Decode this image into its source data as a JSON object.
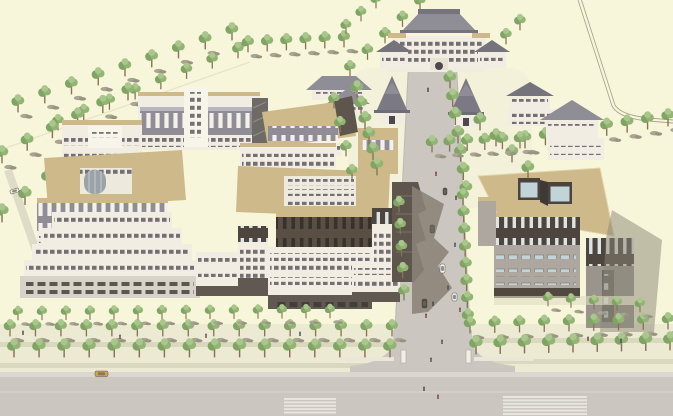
{
  "palette": {
    "bg": "#F8F6DA",
    "fieldLine": "#A9A594",
    "road": "#CBC7C0",
    "roadEdge": "#BDB9B0",
    "roadLight": "#DAD7D0",
    "sidewalk": "#EDEAD3",
    "shadeStrip": "#C9C6AE",
    "shadow": "#8B8376",
    "roofTan": "#CDB98A",
    "roofTanHi": "#E0D0A4",
    "roofGray": "#8F8D96",
    "roofGrayDark": "#75737C",
    "wall": "#F1EDE2",
    "wallHi": "#F7F4EA",
    "wallShade": "#D8D3C8",
    "baseDark": "#5F5952",
    "bandGray": "#908D96",
    "bandBrown": "#55493F",
    "stone": "#ADA79F",
    "stoneDark": "#9B948C",
    "win": "#565059",
    "winBlue": "#C2D4D8",
    "glass": "#9AA3A8",
    "slitLight": "#F3F1E9",
    "slitBlue": "#DCE4E4",
    "slitDark": "#38322C",
    "tree": "#7FA464",
    "treeHi": "#A9C78C",
    "treeMid": "#93B574",
    "trunk": "#8A7355",
    "shrub": "#A9A593",
    "shrubDark": "#98947F",
    "crosswalk": "#EDECE4",
    "carYellow": "#D2A83C"
  },
  "scene": {
    "veg_back_rows": [
      [
        18,
        112,
        232,
        40,
        9,
        1,
        true
      ],
      [
        58,
        130,
        238,
        58,
        8,
        0.9,
        false
      ],
      [
        2,
        163,
        128,
        100,
        6,
        1,
        true
      ],
      [
        2,
        222,
        94,
        152,
        5,
        1.05,
        false
      ],
      [
        248,
        52,
        344,
        47,
        6,
        0.95,
        true
      ],
      [
        350,
        76,
        420,
        10,
        5,
        0.9,
        false
      ],
      [
        492,
        58,
        520,
        30,
        3,
        0.9,
        false
      ],
      [
        346,
        34,
        376,
        8,
        3,
        0.85,
        false
      ],
      [
        525,
        148,
        668,
        126,
        8,
        1,
        true
      ]
    ],
    "veg_front_rows": [
      [
        357,
        98,
        377,
        175,
        6,
        1,
        false
      ],
      [
        450,
        88,
        466,
        198,
        7,
        1,
        false
      ],
      [
        480,
        130,
        528,
        178,
        4,
        1,
        false
      ],
      [
        334,
        108,
        352,
        180,
        4,
        0.9,
        false
      ],
      [
        432,
        152,
        520,
        148,
        6,
        0.95,
        true
      ],
      [
        463,
        205,
        468,
        325,
        8,
        0.95,
        false
      ],
      [
        399,
        212,
        404,
        300,
        5,
        0.9,
        false
      ],
      [
        10,
        336,
        392,
        336,
        16,
        0.95,
        true
      ],
      [
        470,
        333,
        668,
        329,
        9,
        0.95,
        true
      ],
      [
        14,
        357,
        390,
        357,
        16,
        1.05,
        false
      ],
      [
        476,
        354,
        670,
        350,
        9,
        1.05,
        false
      ],
      [
        18,
        320,
        330,
        318,
        14,
        0.8,
        true
      ],
      [
        548,
        306,
        640,
        312,
        5,
        0.8,
        true
      ]
    ],
    "cars": [
      {
        "x": 95,
        "y": 371,
        "w": 13,
        "h": 5.5,
        "c": "#D2A83C",
        "r": 0
      },
      {
        "x": 440,
        "y": 264,
        "w": 5,
        "h": 9,
        "c": "#F3F3EF",
        "r": 0
      },
      {
        "x": 430,
        "y": 225,
        "w": 4.5,
        "h": 8,
        "c": "#6A655F",
        "r": 0
      },
      {
        "x": 10,
        "y": 189,
        "w": 9,
        "h": 4,
        "c": "#EFEFEA",
        "r": -18
      },
      {
        "x": 443,
        "y": 188,
        "w": 4,
        "h": 7,
        "c": "#57524C",
        "r": 0
      },
      {
        "x": 452,
        "y": 293,
        "w": 5,
        "h": 8,
        "c": "#F4F4F0",
        "r": 0
      },
      {
        "x": 422,
        "y": 299,
        "w": 5,
        "h": 9,
        "c": "#4E4A45",
        "r": 0
      }
    ],
    "people": [
      [
        428,
        92
      ],
      [
        436,
        176
      ],
      [
        455,
        247
      ],
      [
        448,
        290
      ],
      [
        433,
        306
      ],
      [
        426,
        318
      ],
      [
        442,
        344
      ],
      [
        431,
        362
      ],
      [
        424,
        391
      ],
      [
        438,
        399
      ],
      [
        300,
        336
      ],
      [
        206,
        338
      ],
      [
        23,
        335
      ],
      [
        588,
        341
      ],
      [
        621,
        343
      ],
      [
        120,
        339
      ],
      [
        456,
        200
      ],
      [
        460,
        312
      ]
    ],
    "person_colors": [
      "#4A4642",
      "#8A3A34",
      "#3F4C6B",
      "#55514B"
    ],
    "crosswalks": [
      {
        "x": 284,
        "y": 398,
        "w": 52,
        "n": 5,
        "dy": 3.4,
        "h": 1.9
      },
      {
        "x": 503,
        "y": 396,
        "w": 84,
        "n": 6,
        "dy": 3.4,
        "h": 1.9
      }
    ]
  }
}
